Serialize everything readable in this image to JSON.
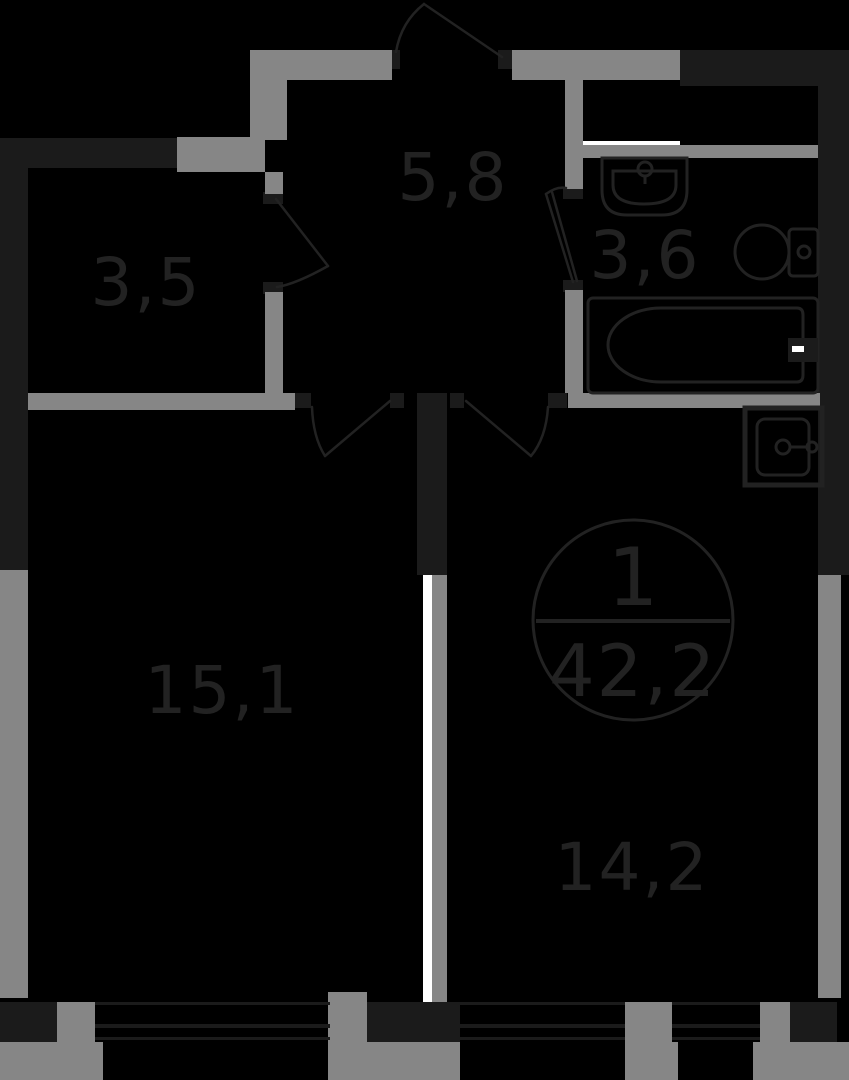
{
  "plan": {
    "apartment_number": "1",
    "total_area": "42,2",
    "rooms": [
      {
        "name": "storage",
        "area": "3,5"
      },
      {
        "name": "hallway",
        "area": "5,8"
      },
      {
        "name": "bathroom",
        "area": "3,6"
      },
      {
        "name": "living-room",
        "area": "15,1"
      },
      {
        "name": "kitchen",
        "area": "14,2"
      }
    ],
    "colors": {
      "background": "#000000",
      "wall_dark": "#1b1b1b",
      "wall_gray": "#868686",
      "line_light": "#ffffff",
      "ink": "#222222"
    }
  }
}
